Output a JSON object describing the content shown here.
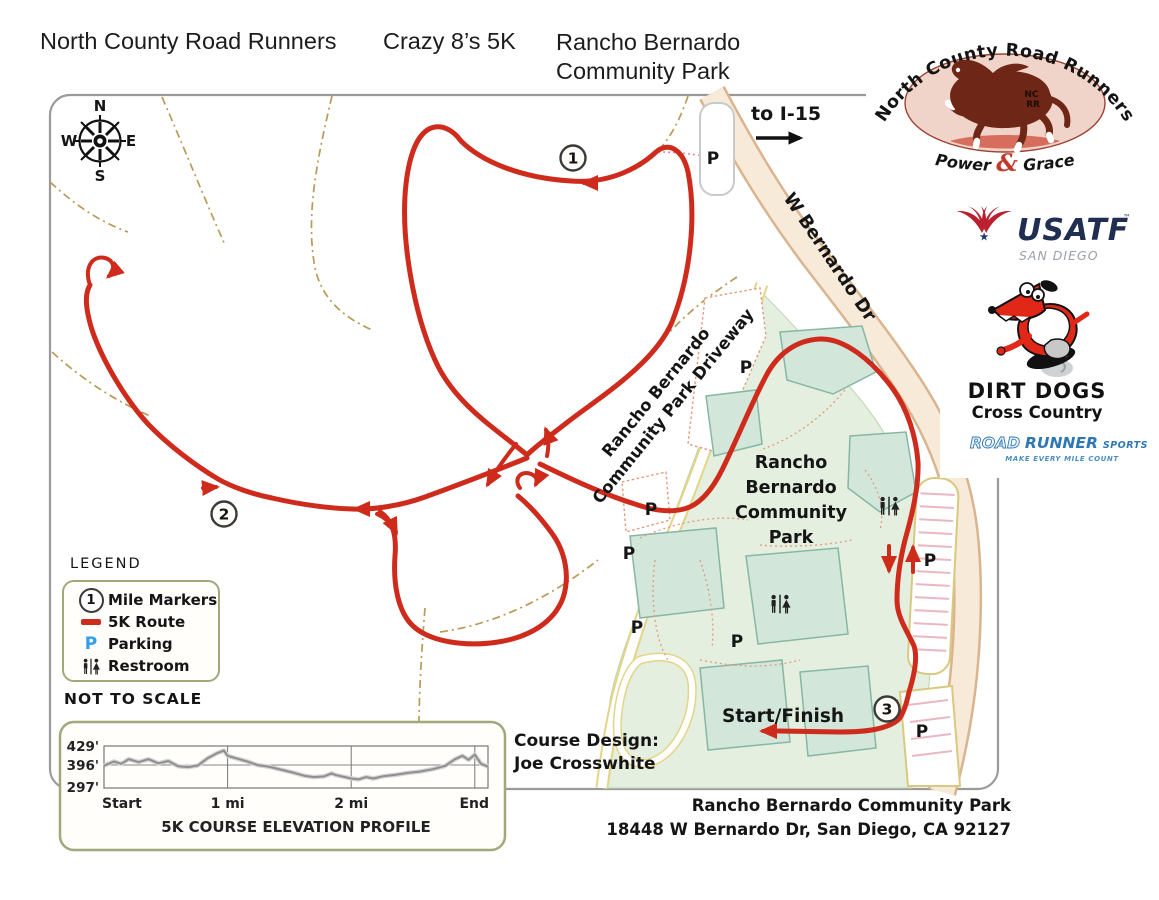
{
  "header": {
    "club": "North County Road Runners",
    "race": "Crazy 8’s 5K",
    "venue": [
      "Rancho Bernardo",
      "Community Park"
    ]
  },
  "logos": {
    "ncrr": {
      "arc": "North County Road Runners",
      "mono1": "NC",
      "mono2": "RR",
      "power": "Power",
      "amp": "&",
      "grace": "Grace"
    },
    "usatf": {
      "name": "USATF",
      "tm": "™",
      "region": "SAN DIEGO"
    },
    "dirt_dogs": {
      "name": "DIRT DOGS",
      "sub": "Cross Country"
    },
    "roadrunner": {
      "road": "ROAD",
      "runner": "RUNNER",
      "sports": "SPORTS",
      "tagline": "MAKE EVERY MILE COUNT"
    }
  },
  "map": {
    "compass": {
      "n": "N",
      "e": "E",
      "s": "S",
      "w": "W"
    },
    "to_i15": "to I-15",
    "road": "W Bernardo Dr",
    "driveway": [
      "Rancho Bernardo",
      "Community Park Driveway"
    ],
    "park": [
      "Rancho",
      "Bernardo",
      "Community",
      "Park"
    ],
    "start_finish": "Start/Finish",
    "mile1": "1",
    "mile2": "2",
    "mile3": "3",
    "parking": "P"
  },
  "legend": {
    "title": "LEGEND",
    "marker_sample": "1",
    "items": [
      "Mile Markers",
      "5K Route",
      "Parking",
      "Restroom"
    ],
    "note": "NOT TO SCALE"
  },
  "credits": {
    "design_label": "Course Design:",
    "designer": "Joe Crosswhite"
  },
  "footer": {
    "line1": "Rancho Bernardo Community Park",
    "line2": "18448 W Bernardo Dr, San Diego, CA 92127"
  },
  "chart_data": {
    "type": "line",
    "title": "5K COURSE ELEVATION PROFILE",
    "xlabel": "distance (miles)",
    "ylabel": "elevation (feet)",
    "x_ticks": [
      "Start",
      "1 mi",
      "2 mi",
      "End"
    ],
    "y_ticks": [
      "429'",
      "396'",
      "297'"
    ],
    "x_range": [
      0,
      3.107
    ],
    "y_anchors": {
      "top": 429,
      "grid": 396,
      "bottom": 297
    },
    "x_gridlines_miles": [
      1,
      2,
      3
    ],
    "legend_position": "none",
    "points": [
      [
        0.0,
        393
      ],
      [
        0.08,
        402
      ],
      [
        0.14,
        398
      ],
      [
        0.2,
        406
      ],
      [
        0.28,
        401
      ],
      [
        0.36,
        406
      ],
      [
        0.44,
        399
      ],
      [
        0.52,
        403
      ],
      [
        0.6,
        391
      ],
      [
        0.68,
        387
      ],
      [
        0.76,
        394
      ],
      [
        0.84,
        408
      ],
      [
        0.92,
        417
      ],
      [
        0.97,
        421
      ],
      [
        1.0,
        412
      ],
      [
        1.08,
        407
      ],
      [
        1.16,
        402
      ],
      [
        1.24,
        396
      ],
      [
        1.34,
        388
      ],
      [
        1.44,
        375
      ],
      [
        1.54,
        362
      ],
      [
        1.62,
        350
      ],
      [
        1.7,
        344
      ],
      [
        1.78,
        347
      ],
      [
        1.84,
        360
      ],
      [
        1.88,
        352
      ],
      [
        1.95,
        344
      ],
      [
        2.0,
        338
      ],
      [
        2.06,
        334
      ],
      [
        2.12,
        344
      ],
      [
        2.18,
        338
      ],
      [
        2.26,
        348
      ],
      [
        2.36,
        354
      ],
      [
        2.46,
        362
      ],
      [
        2.56,
        368
      ],
      [
        2.66,
        378
      ],
      [
        2.76,
        392
      ],
      [
        2.84,
        406
      ],
      [
        2.9,
        412
      ],
      [
        2.95,
        405
      ],
      [
        3.0,
        414
      ],
      [
        3.05,
        398
      ],
      [
        3.107,
        389
      ]
    ]
  },
  "colors": {
    "route_red": "#cf2b1c",
    "parking_blue": "#2e9df0",
    "park_fill": "#e4efdf",
    "field_fill": "#d3e6da",
    "road_fill": "#f8ead9",
    "trail_tan": "#b99a56",
    "panel_border": "#a3a87b",
    "elevation_line": "#8f8f8f"
  }
}
